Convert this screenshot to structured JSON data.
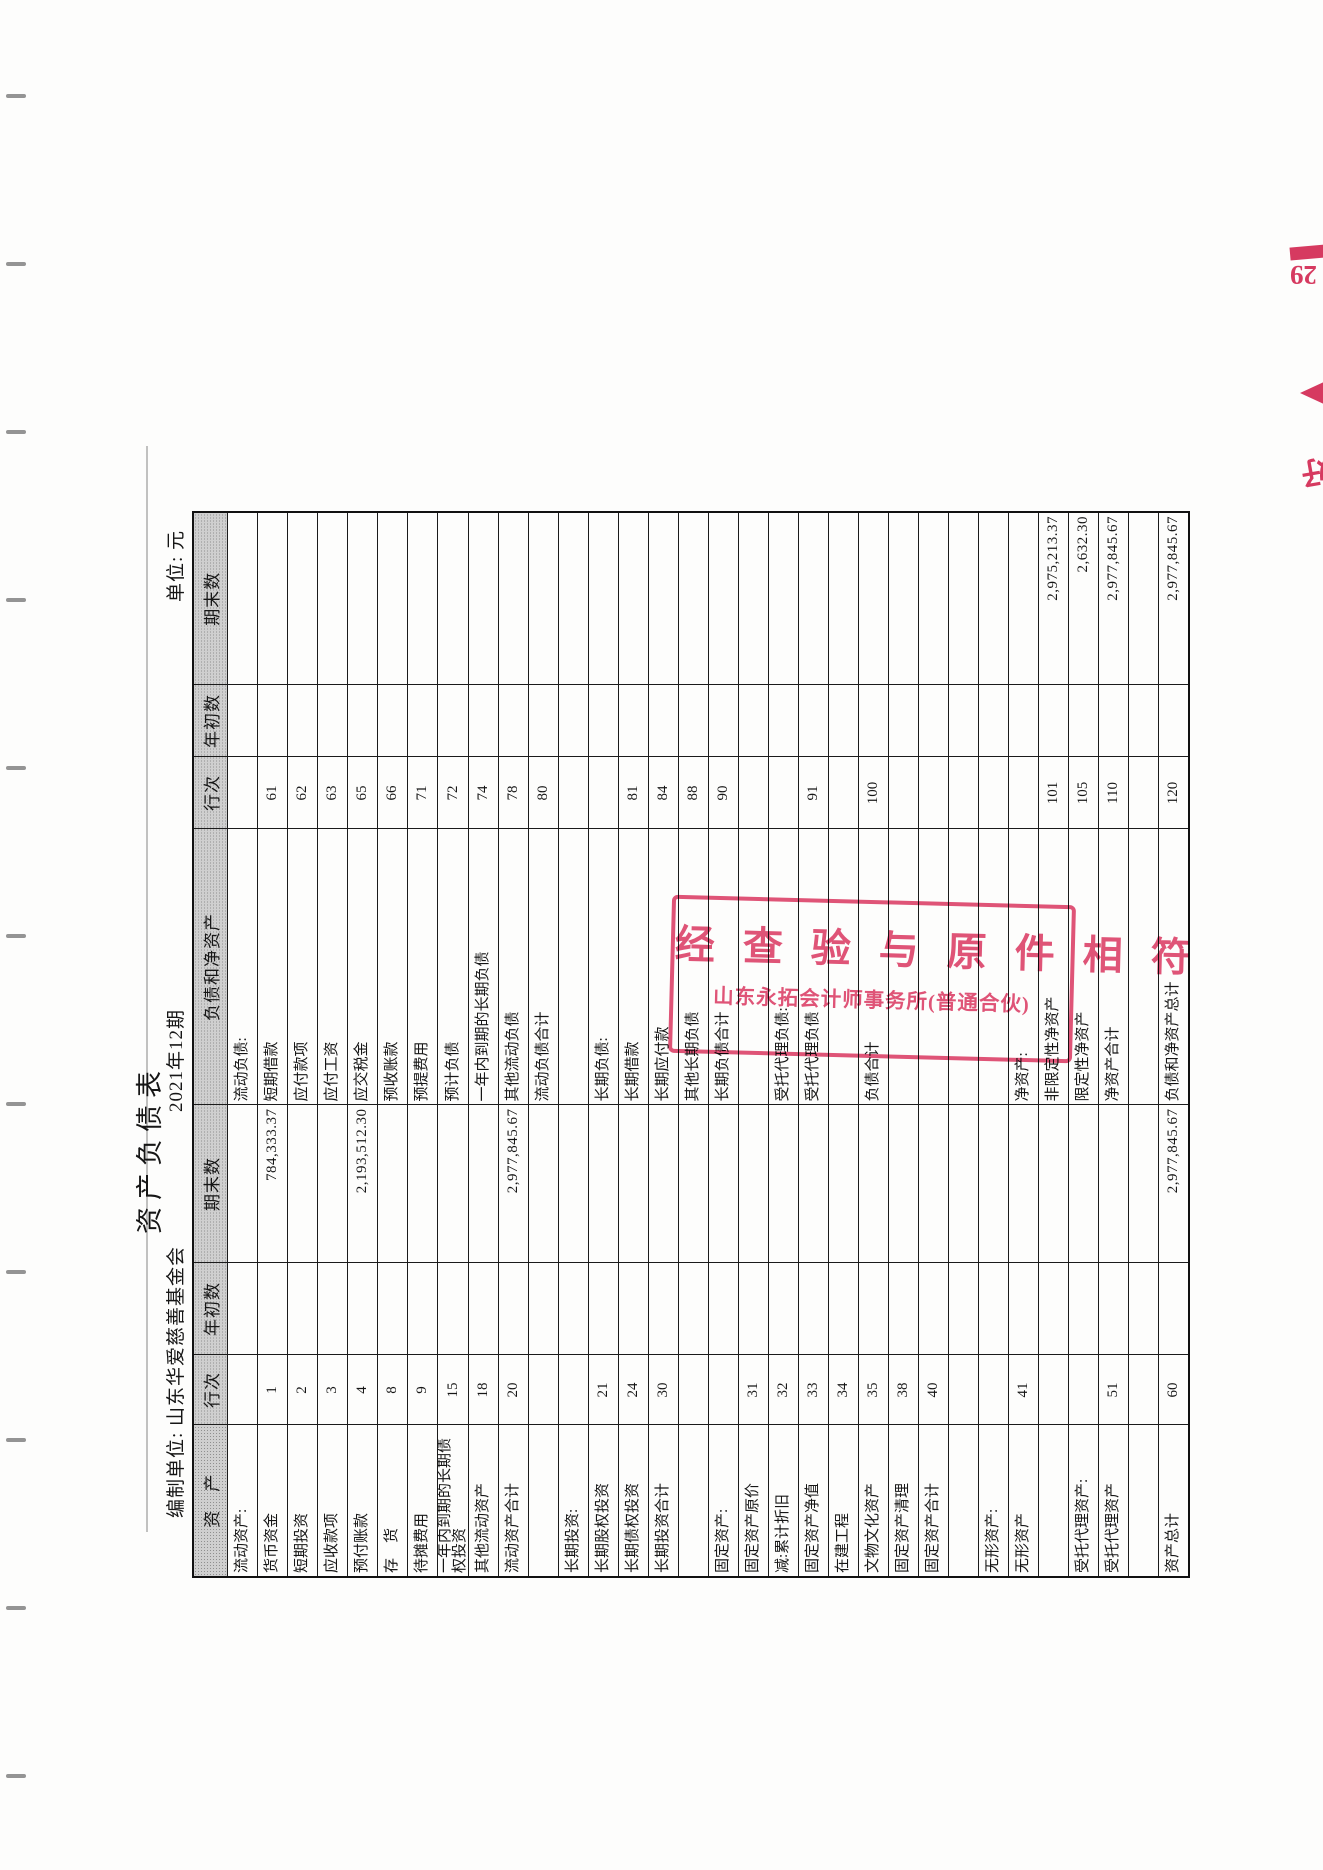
{
  "document": {
    "title": "资产负债表",
    "org_label": "编制单位: 山东华爱慈善基金会",
    "period": "2021年12期",
    "unit_label": "单位: 元"
  },
  "table": {
    "headers": {
      "asset": "资　产",
      "line_no": "行次",
      "beginning": "年初数",
      "ending": "期末数",
      "liability_equity": "负债和净资产"
    },
    "rows": [
      {
        "a": "流动资产:",
        "an": "",
        "ab": "",
        "ae": "",
        "l": "流动负债:",
        "ln": "",
        "lb": "",
        "le": ""
      },
      {
        "a": "货币资金",
        "an": "1",
        "ab": "",
        "ae": "784,333.37",
        "l": "短期借款",
        "ln": "61",
        "lb": "",
        "le": ""
      },
      {
        "a": "短期投资",
        "an": "2",
        "ab": "",
        "ae": "",
        "l": "应付款项",
        "ln": "62",
        "lb": "",
        "le": ""
      },
      {
        "a": "应收款项",
        "an": "3",
        "ab": "",
        "ae": "",
        "l": "应付工资",
        "ln": "63",
        "lb": "",
        "le": ""
      },
      {
        "a": "预付账款",
        "an": "4",
        "ab": "",
        "ae": "2,193,512.30",
        "l": "应交税金",
        "ln": "65",
        "lb": "",
        "le": ""
      },
      {
        "a": "存　货",
        "an": "8",
        "ab": "",
        "ae": "",
        "l": "预收账款",
        "ln": "66",
        "lb": "",
        "le": ""
      },
      {
        "a": "待摊费用",
        "an": "9",
        "ab": "",
        "ae": "",
        "l": "预提费用",
        "ln": "71",
        "lb": "",
        "le": ""
      },
      {
        "a": "一年内到期的长期债权投资",
        "an": "15",
        "ab": "",
        "ae": "",
        "l": "预计负债",
        "ln": "72",
        "lb": "",
        "le": ""
      },
      {
        "a": "其他流动资产",
        "an": "18",
        "ab": "",
        "ae": "",
        "l": "一年内到期的长期负债",
        "ln": "74",
        "lb": "",
        "le": ""
      },
      {
        "a": "流动资产合计",
        "an": "20",
        "ab": "",
        "ae": "2,977,845.67",
        "l": "其他流动负债",
        "ln": "78",
        "lb": "",
        "le": ""
      },
      {
        "a": "",
        "an": "",
        "ab": "",
        "ae": "",
        "l": "流动负债合计",
        "ln": "80",
        "lb": "",
        "le": ""
      },
      {
        "a": "长期投资:",
        "an": "",
        "ab": "",
        "ae": "",
        "l": "",
        "ln": "",
        "lb": "",
        "le": ""
      },
      {
        "a": "长期股权投资",
        "an": "21",
        "ab": "",
        "ae": "",
        "l": "长期负债:",
        "ln": "",
        "lb": "",
        "le": ""
      },
      {
        "a": "长期债权投资",
        "an": "24",
        "ab": "",
        "ae": "",
        "l": "长期借款",
        "ln": "81",
        "lb": "",
        "le": ""
      },
      {
        "a": "长期投资合计",
        "an": "30",
        "ab": "",
        "ae": "",
        "l": "长期应付款",
        "ln": "84",
        "lb": "",
        "le": ""
      },
      {
        "a": "",
        "an": "",
        "ab": "",
        "ae": "",
        "l": "其他长期负债",
        "ln": "88",
        "lb": "",
        "le": ""
      },
      {
        "a": "固定资产:",
        "an": "",
        "ab": "",
        "ae": "",
        "l": "长期负债合计",
        "ln": "90",
        "lb": "",
        "le": ""
      },
      {
        "a": "固定资产原价",
        "an": "31",
        "ab": "",
        "ae": "",
        "l": "",
        "ln": "",
        "lb": "",
        "le": ""
      },
      {
        "a": "减:累计折旧",
        "an": "32",
        "ab": "",
        "ae": "",
        "l": "受托代理负债:",
        "ln": "",
        "lb": "",
        "le": ""
      },
      {
        "a": "固定资产净值",
        "an": "33",
        "ab": "",
        "ae": "",
        "l": "受托代理负债",
        "ln": "91",
        "lb": "",
        "le": ""
      },
      {
        "a": "在建工程",
        "an": "34",
        "ab": "",
        "ae": "",
        "l": "",
        "ln": "",
        "lb": "",
        "le": ""
      },
      {
        "a": "文物文化资产",
        "an": "35",
        "ab": "",
        "ae": "",
        "l": "负债合计",
        "ln": "100",
        "lb": "",
        "le": ""
      },
      {
        "a": "固定资产清理",
        "an": "38",
        "ab": "",
        "ae": "",
        "l": "",
        "ln": "",
        "lb": "",
        "le": ""
      },
      {
        "a": "固定资产合计",
        "an": "40",
        "ab": "",
        "ae": "",
        "l": "",
        "ln": "",
        "lb": "",
        "le": ""
      },
      {
        "a": "",
        "an": "",
        "ab": "",
        "ae": "",
        "l": "",
        "ln": "",
        "lb": "",
        "le": ""
      },
      {
        "a": "无形资产:",
        "an": "",
        "ab": "",
        "ae": "",
        "l": "",
        "ln": "",
        "lb": "",
        "le": ""
      },
      {
        "a": "无形资产",
        "an": "41",
        "ab": "",
        "ae": "",
        "l": "净资产:",
        "ln": "",
        "lb": "",
        "le": ""
      },
      {
        "a": "",
        "an": "",
        "ab": "",
        "ae": "",
        "l": "非限定性净资产",
        "ln": "101",
        "lb": "",
        "le": "2,975,213.37"
      },
      {
        "a": "受托代理资产:",
        "an": "",
        "ab": "",
        "ae": "",
        "l": "限定性净资产",
        "ln": "105",
        "lb": "",
        "le": "2,632.30"
      },
      {
        "a": "受托代理资产",
        "an": "51",
        "ab": "",
        "ae": "",
        "l": "净资产合计",
        "ln": "110",
        "lb": "",
        "le": "2,977,845.67"
      },
      {
        "a": "",
        "an": "",
        "ab": "",
        "ae": "",
        "l": "",
        "ln": "",
        "lb": "",
        "le": ""
      },
      {
        "a": "资产总计",
        "an": "60",
        "ab": "",
        "ae": "2,977,845.67",
        "l": "负债和净资产总计",
        "ln": "120",
        "lb": "",
        "le": "2,977,845.67"
      }
    ]
  },
  "stamp": {
    "line1": "经 查 验 与 原 件 相 符",
    "line2": "山东永拓会计师事务所(普通合伙)",
    "color": "#df476e"
  },
  "edge_marks": {
    "page_tab_number": "29",
    "arrow": "left-triangle",
    "partial_character": "好",
    "color": "#d63a60",
    "binder_mark_count": 11
  }
}
